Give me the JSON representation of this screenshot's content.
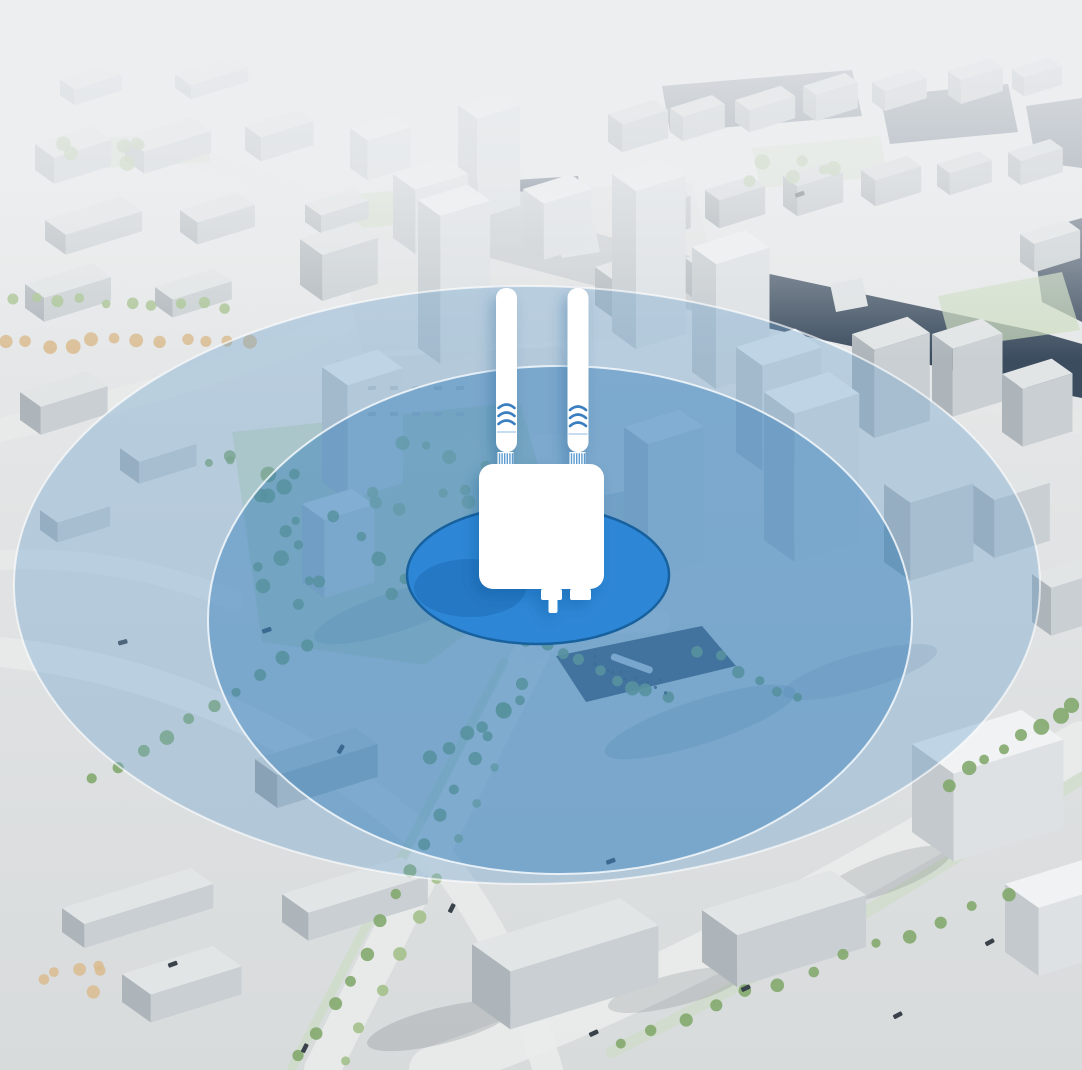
{
  "illustration": {
    "id": "outdoor-access-point-city-coverage",
    "device": {
      "icon": "outdoor-access-point-icon",
      "antenna_icon": "antenna-icon",
      "antenna_count": 2,
      "signal_waves_icon": "signal-waves-icon",
      "antenna_connector_icon": "threaded-connector-icon",
      "connector_icons": [
        "power-plug-icon",
        "lan-port-icon"
      ],
      "color": "#ffffff"
    },
    "coverage_zones": [
      {
        "id": "core-zone",
        "fill": "#2e87d6",
        "stroke": "#17619f",
        "fill_opacity": "1"
      },
      {
        "id": "strong-signal-zone",
        "fill": "#1d71b5",
        "stroke": "#f4f9fd",
        "fill_opacity": "0.38"
      },
      {
        "id": "extended-signal-zone",
        "fill": "#6fa3cc",
        "stroke": "#ffffff",
        "fill_opacity": "0.38"
      }
    ],
    "palette": {
      "sky_fog": "#eceef0",
      "ground_top": "#eef0f1",
      "ground_bottom": "#d8dbdc",
      "building_top": "#e2e5e6",
      "building_face": "#c9cfd2",
      "building_shade": "#aeb5ba",
      "water": "#2e3f53",
      "road": "#e9ebea",
      "green_verge": "#c9dcc0",
      "tree_green": "#83a86e",
      "tree_green_light": "#a3c08b",
      "tree_autumn": "#d9bb8f",
      "car": "#39424a",
      "figure": "#3f4b57",
      "accent_blue": "#2e87d6"
    }
  }
}
